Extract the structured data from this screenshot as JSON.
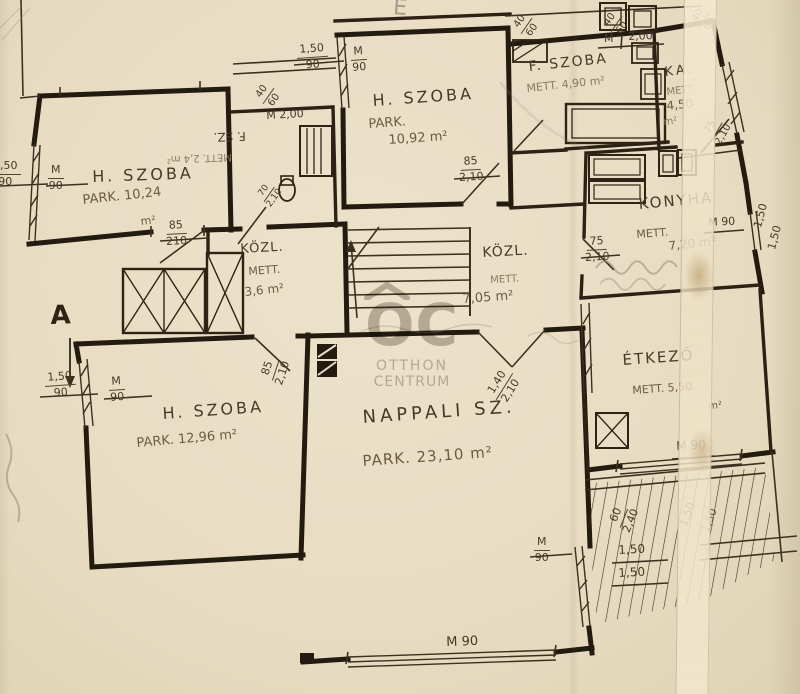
{
  "meta": {
    "document_type": "hand-drawn apartment floor plan (scan)",
    "language": "hu"
  },
  "watermark": {
    "logo": "OC",
    "line1": "OTTHON",
    "line2": "CENTRUM"
  },
  "markers": {
    "section_a": "A",
    "pencil_e": "E"
  },
  "rooms": {
    "hszoba_top_left": {
      "name": "H. SZOBA",
      "area": "PARK. 10,24",
      "unit": "m²"
    },
    "hszoba_top_mid": {
      "name": "H. SZOBA",
      "area_prefix": "PARK.",
      "area": "10,92 m²"
    },
    "fszoba": {
      "name": "F. SZOBA",
      "area": "METT. 4,90 m²"
    },
    "kamra": {
      "name": "KA.",
      "area_prefix": "METT.",
      "area": "4,50",
      "unit": "m²"
    },
    "konyha": {
      "name": "KONYHA",
      "area_prefix": "METT.",
      "area": "7,20 m²"
    },
    "kozl_small": {
      "name": "KÖZL.",
      "area_prefix": "METT.",
      "area": "3,6 m²"
    },
    "kozl_main": {
      "name": "KÖZL.",
      "area_prefix": "METT.",
      "area": "7,05 m²"
    },
    "fsz_wc": {
      "name": "F. SZ.",
      "area": "METT. 2,4 m²"
    },
    "etkezo": {
      "name": "ÉTKEZŐ",
      "area": "METT. 5,50",
      "unit": "m²"
    },
    "hszoba_bottom_left": {
      "name": "H. SZOBA",
      "area": "PARK. 12,96 m²"
    },
    "nappali": {
      "name": "NAPPALI SZ.",
      "area": "PARK. 23,10 m²"
    }
  },
  "dims": {
    "frac_40_60": {
      "top": "40",
      "bottom": "60"
    },
    "frac_150_90": {
      "top": "1,50",
      "bottom": "90"
    },
    "frac_m_90": {
      "top": "M",
      "bottom": "90"
    },
    "frac_85_210": {
      "top": "85",
      "bottom": "210"
    },
    "frac_85_2_10": {
      "top": "85",
      "bottom": "2,10"
    },
    "frac_75_2_10": {
      "top": "75",
      "bottom": "2,10"
    },
    "frac_70_2_10": {
      "top": "70",
      "bottom": "2,10"
    },
    "frac_140_2_10": {
      "top": "1,40",
      "bottom": "2,10"
    },
    "frac_60_2_40": {
      "top": "60",
      "bottom": "2,40"
    },
    "m": "M",
    "two_00": "2,00",
    "m_2_00": "M 2,00",
    "m90": "M 90",
    "len_1_50": "1,50"
  }
}
